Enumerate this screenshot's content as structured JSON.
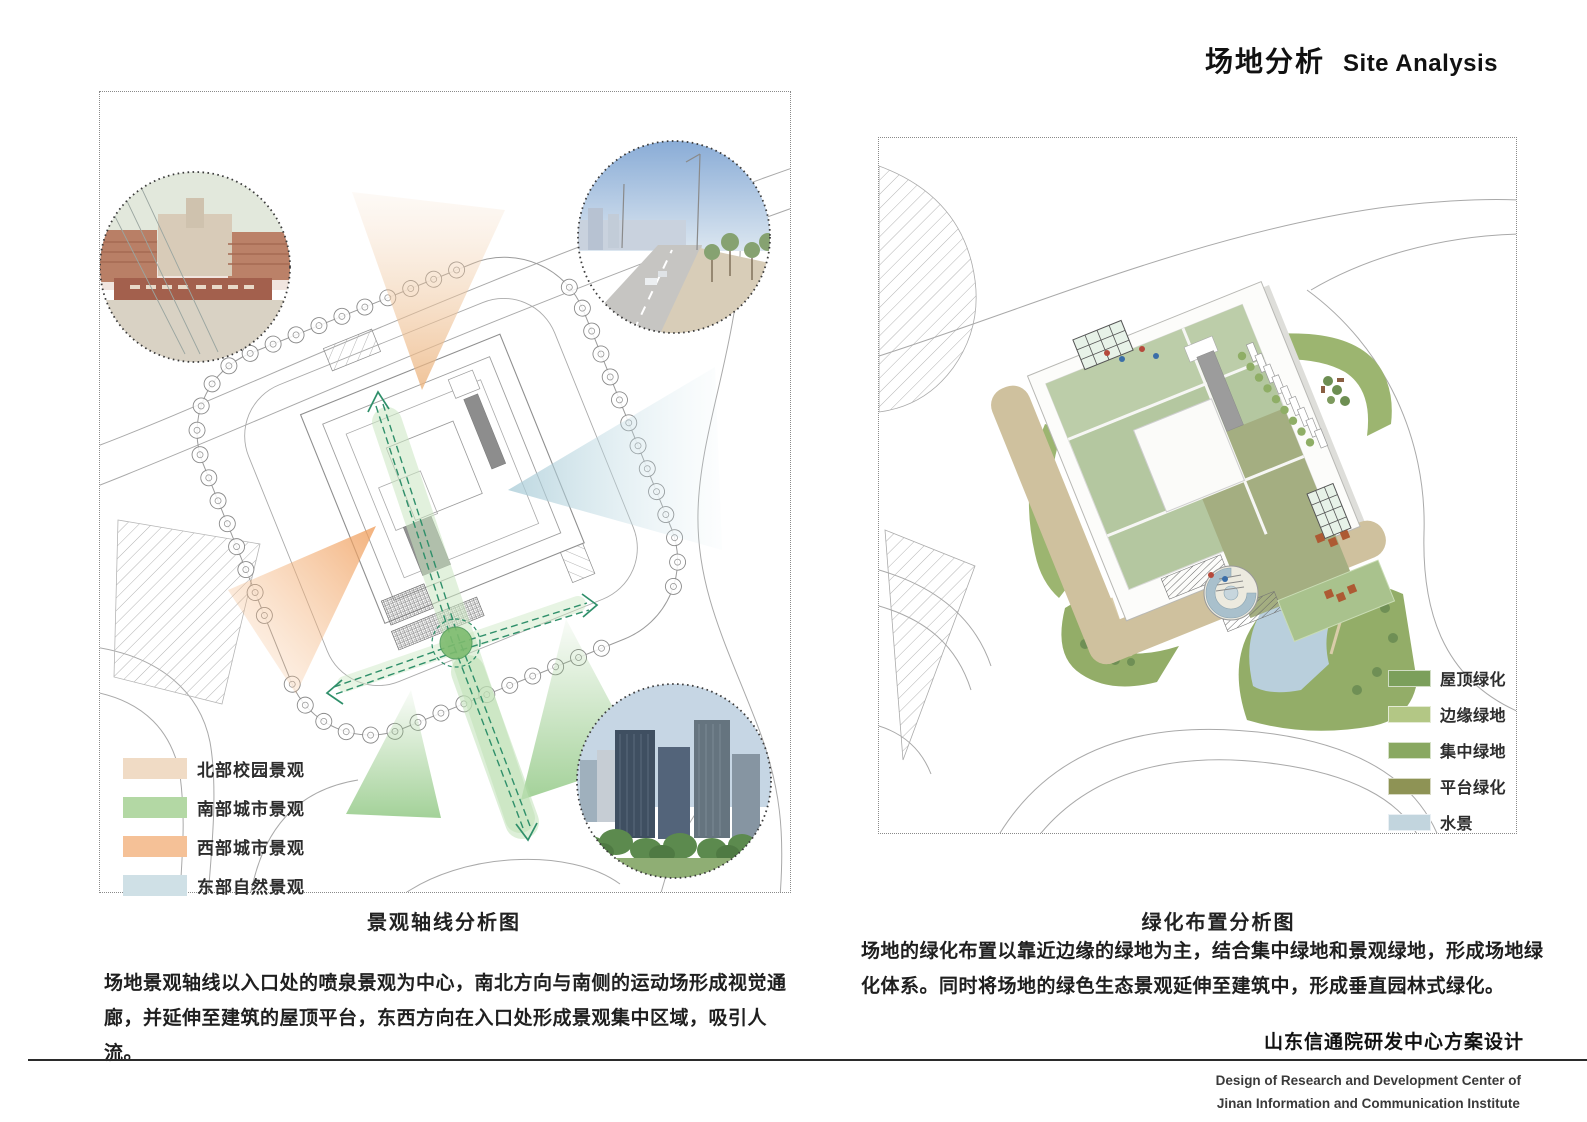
{
  "header": {
    "title_zh": "场地分析",
    "title_en": "Site Analysis"
  },
  "left_panel": {
    "caption": "景观轴线分析图",
    "description": "场地景观轴线以入口处的喷泉景观为中心，南北方向与南侧的运动场形成视觉通廊，并延伸至建筑的屋顶平台，东西方向在入口处形成景观集中区域，吸引人流。",
    "legend": [
      {
        "label": "北部校园景观",
        "color": "#f0dbc5"
      },
      {
        "label": "南部城市景观",
        "color": "#b3d8a4"
      },
      {
        "label": "西部城市景观",
        "color": "#f5c197"
      },
      {
        "label": "东部自然景观",
        "color": "#cfe0e6"
      }
    ],
    "photos": [
      "campus-gate-photo",
      "street-view-photo",
      "city-skyline-photo"
    ],
    "accent_axis_color": "#2f8f6a"
  },
  "right_panel": {
    "caption": "绿化布置分析图",
    "description": "场地的绿化布置以靠近边缘的绿地为主，结合集中绿地和景观绿地，形成场地绿化体系。同时将场地的绿色生态景观延伸至建筑中，形成垂直园林式绿化。",
    "legend": [
      {
        "label": "屋顶绿化",
        "color": "#7b9f5b"
      },
      {
        "label": "边缘绿地",
        "color": "#b3c785"
      },
      {
        "label": "集中绿地",
        "color": "#89a861"
      },
      {
        "label": "平台绿化",
        "color": "#8e9355"
      },
      {
        "label": "水景",
        "color": "#c2d5de"
      }
    ]
  },
  "footer": {
    "project_zh": "山东信通院研发中心方案设计",
    "project_en_line1": "Design of Research and Development Center of",
    "project_en_line2": "Jinan Information and Communication Institute"
  }
}
